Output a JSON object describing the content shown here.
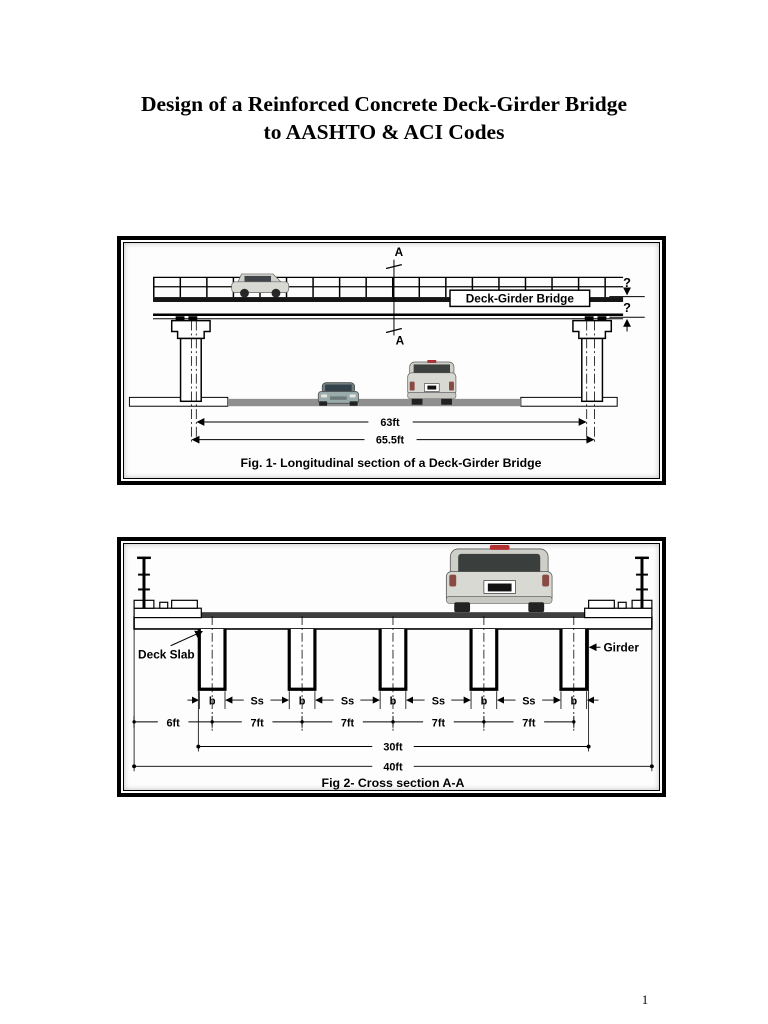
{
  "page": {
    "title_line1": "Design of a Reinforced Concrete Deck-Girder Bridge",
    "title_line2": "to AASHTO & ACI Codes",
    "page_number": "1"
  },
  "fig1": {
    "caption": "Fig. 1- Longitudinal section of a Deck-Girder Bridge",
    "bridge_label": "Deck-Girder Bridge",
    "section_label_top": "A",
    "section_label_bottom": "A",
    "unknown_depth_top": "?",
    "unknown_depth_bottom": "?",
    "dim_clear_span": "63ft",
    "dim_total_span": "65.5ft"
  },
  "fig2": {
    "caption": "Fig 2- Cross section A-A",
    "deck_slab_label": "Deck Slab",
    "girder_label": "Girder",
    "girder_width_labels": [
      "b",
      "b",
      "b",
      "b",
      "b"
    ],
    "spacing_labels": [
      "Ss",
      "Ss",
      "Ss",
      "Ss"
    ],
    "edge_dim": "6ft",
    "spacing_dims": [
      "7ft",
      "7ft",
      "7ft",
      "7ft"
    ],
    "dim_roadway": "30ft",
    "dim_total_width": "40ft"
  },
  "colors": {
    "ink": "#000000",
    "asphalt": "#3f3f3f",
    "road": "#8f8f8f",
    "vehicle_silver": "#d9d9d3",
    "window_dark": "#3a3e3c"
  }
}
